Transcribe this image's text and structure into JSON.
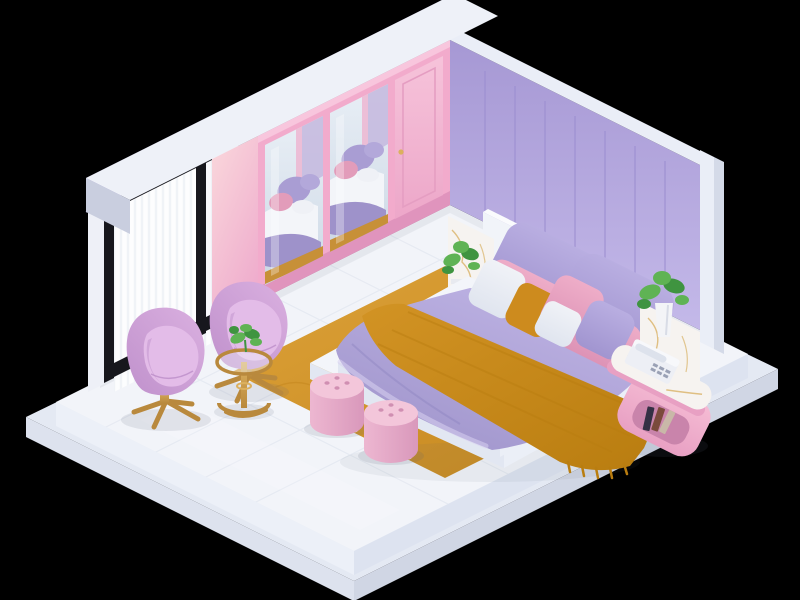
{
  "canvas": {
    "width": 800,
    "height": 600
  },
  "scene": {
    "description": "Isometric 3D render of a pastel purple and pink bedroom floating on a white two-tier platform against a black background",
    "objects": [
      {
        "name": "platform-base",
        "desc": "two-tier white floating floor slab with glossy tiles"
      },
      {
        "name": "left-wall",
        "desc": "wall with black framed window, sheer white curtains and pink panel"
      },
      {
        "name": "right-wall",
        "desc": "lavender vertical panel wall with white trim edges"
      },
      {
        "name": "header-beam",
        "desc": "white ceiling beam with lavender fascia over the left wall"
      },
      {
        "name": "wardrobe",
        "desc": "pink wardrobe with two mirrored doors reflecting the bed and one solid pink door"
      },
      {
        "name": "bed",
        "desc": "white platform bed with lavender duvet, mustard throw blanket and stacked accent pillows"
      },
      {
        "name": "pillows",
        "colors": [
          "lavender",
          "lavender",
          "pink",
          "pink",
          "white",
          "mustard",
          "pink",
          "white",
          "lavender"
        ]
      },
      {
        "name": "nightstand-left",
        "desc": "pink nightstand with terrazzo top, potted plant and camera on open shelf"
      },
      {
        "name": "nightstand-right",
        "desc": "pink curved nightstand with marble top, white telephone, books and plant in tall vase"
      },
      {
        "name": "poufs",
        "desc": "two pink button-tufted round poufs on the rug"
      },
      {
        "name": "egg-chairs",
        "desc": "two lilac egg swivel chairs with brass star bases"
      },
      {
        "name": "side-table",
        "desc": "round brass and glass side table with a small green plant"
      },
      {
        "name": "rug",
        "desc": "mustard gold area rug under and beside the bed"
      }
    ]
  },
  "palette": {
    "bg": "#000000",
    "slab_top": "#f2f4f9",
    "slab_side_left": "#ecf0f8",
    "slab_side_right": "#dde3f0",
    "base_top": "#e4e9f3",
    "base_side_left": "#dde2ee",
    "base_side_right": "#d0d6e4",
    "tile_line": "#e1e6f0",
    "wall_lav_top": "#a698d4",
    "wall_lav_bottom": "#c4b9e9",
    "panel_seam": "#9c8ed0",
    "trim_white": "#eaeef7",
    "trim_side": "#d4dae8",
    "beam_top": "#eef1f8",
    "beam_fascia_1": "#bcafe5",
    "beam_fascia_2": "#a294d3",
    "beam_end": "#c9cedf",
    "left_wall_base": "#cfc7ec",
    "white_column": "#eef0f7",
    "window_frame": "#17171d",
    "glass": "#f6f9fc",
    "curtain": "#fdfdfe",
    "curtain_stripe": "#e6eaf1",
    "pink_wall_1": "#fad8dc",
    "pink_wall_2": "#efadcd",
    "wardrobe_frame": "#f2abcc",
    "wardrobe_frame_dark": "#e094bd",
    "door_pink_1": "#f6c3da",
    "door_pink_2": "#eda7c9",
    "mirror_1": "#e9eff6",
    "mirror_2": "#ccd8e5",
    "rug_1": "#dda239",
    "rug_2": "#c4861d",
    "bed_white": "#f3f5fa",
    "bed_side_left": "#e2e7f2",
    "bed_side_right": "#ebeff7",
    "headboard": "#f1f4f9",
    "headboard_side": "#e0e5f0",
    "duvet_light": "#beb3e4",
    "duvet_dark": "#9d92c9",
    "duvet_fold": "#8f84c0",
    "sheet_light": "#d8d2f0",
    "throw_1": "#d29324",
    "throw_2": "#b97d10",
    "pillow_lav_1": "#b9aee1",
    "pillow_lav_2": "#a195d0",
    "pillow_pink_1": "#eeadc8",
    "pillow_pink_2": "#dd93b6",
    "pillow_white": "#f0f2f7",
    "pillow_white_2": "#e0e5ef",
    "pillow_mustard": "#cd8b1e",
    "pouf_top": "#f3c6da",
    "pouf_side_1": "#edb7d1",
    "pouf_side_2": "#d998bb",
    "button_pink": "#d08fb2",
    "chair_1": "#dab0e0",
    "chair_2": "#c091cc",
    "chair_seat": "#e3bce8",
    "gold": "#b9893d",
    "gold_light": "#dcb05e",
    "stand_pink_1": "#f5bcd4",
    "stand_pink_2": "#e8a0c3",
    "shelf_inner": "#c984ab",
    "terrazzo": "#f7f1ea",
    "marble": "#f6f3f0",
    "marble_vein": "#d9b266",
    "plant_green": "#5fb354",
    "plant_green_dark": "#3f9440",
    "pot_white": "#f3f4f7",
    "phone_white": "#edeff5",
    "phone_detail": "#9aa1b5",
    "book_dark": "#343044",
    "shadow": "#5c6378"
  }
}
